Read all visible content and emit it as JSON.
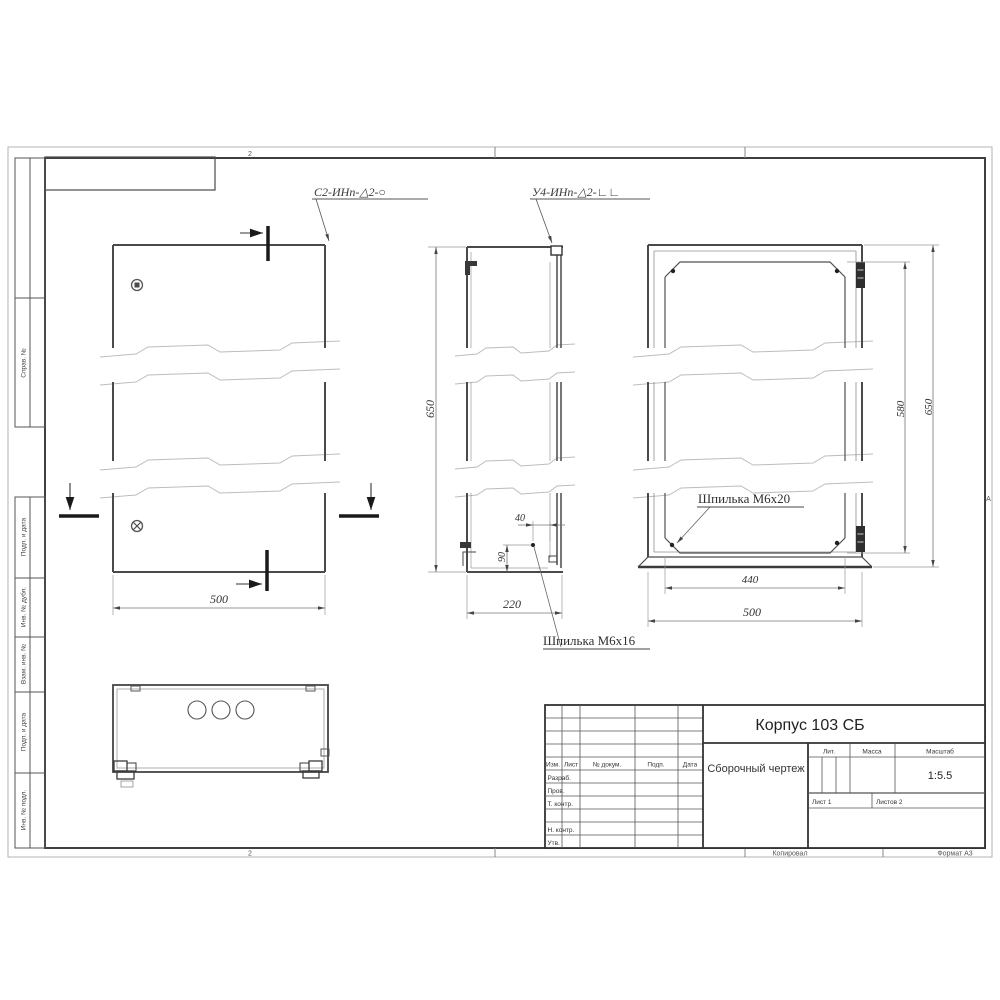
{
  "sheet": {
    "zone_top": "2",
    "zone_bottom": "2",
    "zone_right": "А",
    "kopiroval": "Копировал",
    "format": "Формат А3"
  },
  "margin_stamps": {
    "sprav": "Справ. №",
    "podp_data_1": "Подп. и дата",
    "inv_dubl": "Инв. № дубл.",
    "vzam_inv": "Взам. инв. №",
    "podp_data_2": "Подп. и дата",
    "inv_podl": "Инв. № подл."
  },
  "annotations": {
    "weld_1": "С2-ИНп-△2-○",
    "weld_2": "У4-ИНп-△2-∟∟",
    "stud_back": "Шпилька М6х20",
    "stud_side": "Шпилька М6х16"
  },
  "dimensions": {
    "front_width": "500",
    "side_height": "650",
    "side_depth": "220",
    "stud_offset_x": "40",
    "stud_offset_y": "90",
    "back_inner_width": "440",
    "back_width": "500",
    "back_inner_height": "580",
    "back_height": "650"
  },
  "title_block": {
    "designation": "Корпус 103 СБ",
    "doc_type": "Сборочный чертеж",
    "lit_label": "Лит.",
    "mass_label": "Масса",
    "scale_label": "Масштаб",
    "scale_value": "1:5.5",
    "sheet_info": "Лист 1",
    "sheets_info": "Листов 2",
    "col_izm": "Изм.",
    "col_list": "Лист",
    "col_doc": "№ докум.",
    "col_podp": "Подп.",
    "col_data": "Дата",
    "row_razrab": "Разраб.",
    "row_prov": "Пров.",
    "row_tkontr": "Т. контр.",
    "row_nkontr": "Н. контр.",
    "row_utv": "Утв."
  }
}
